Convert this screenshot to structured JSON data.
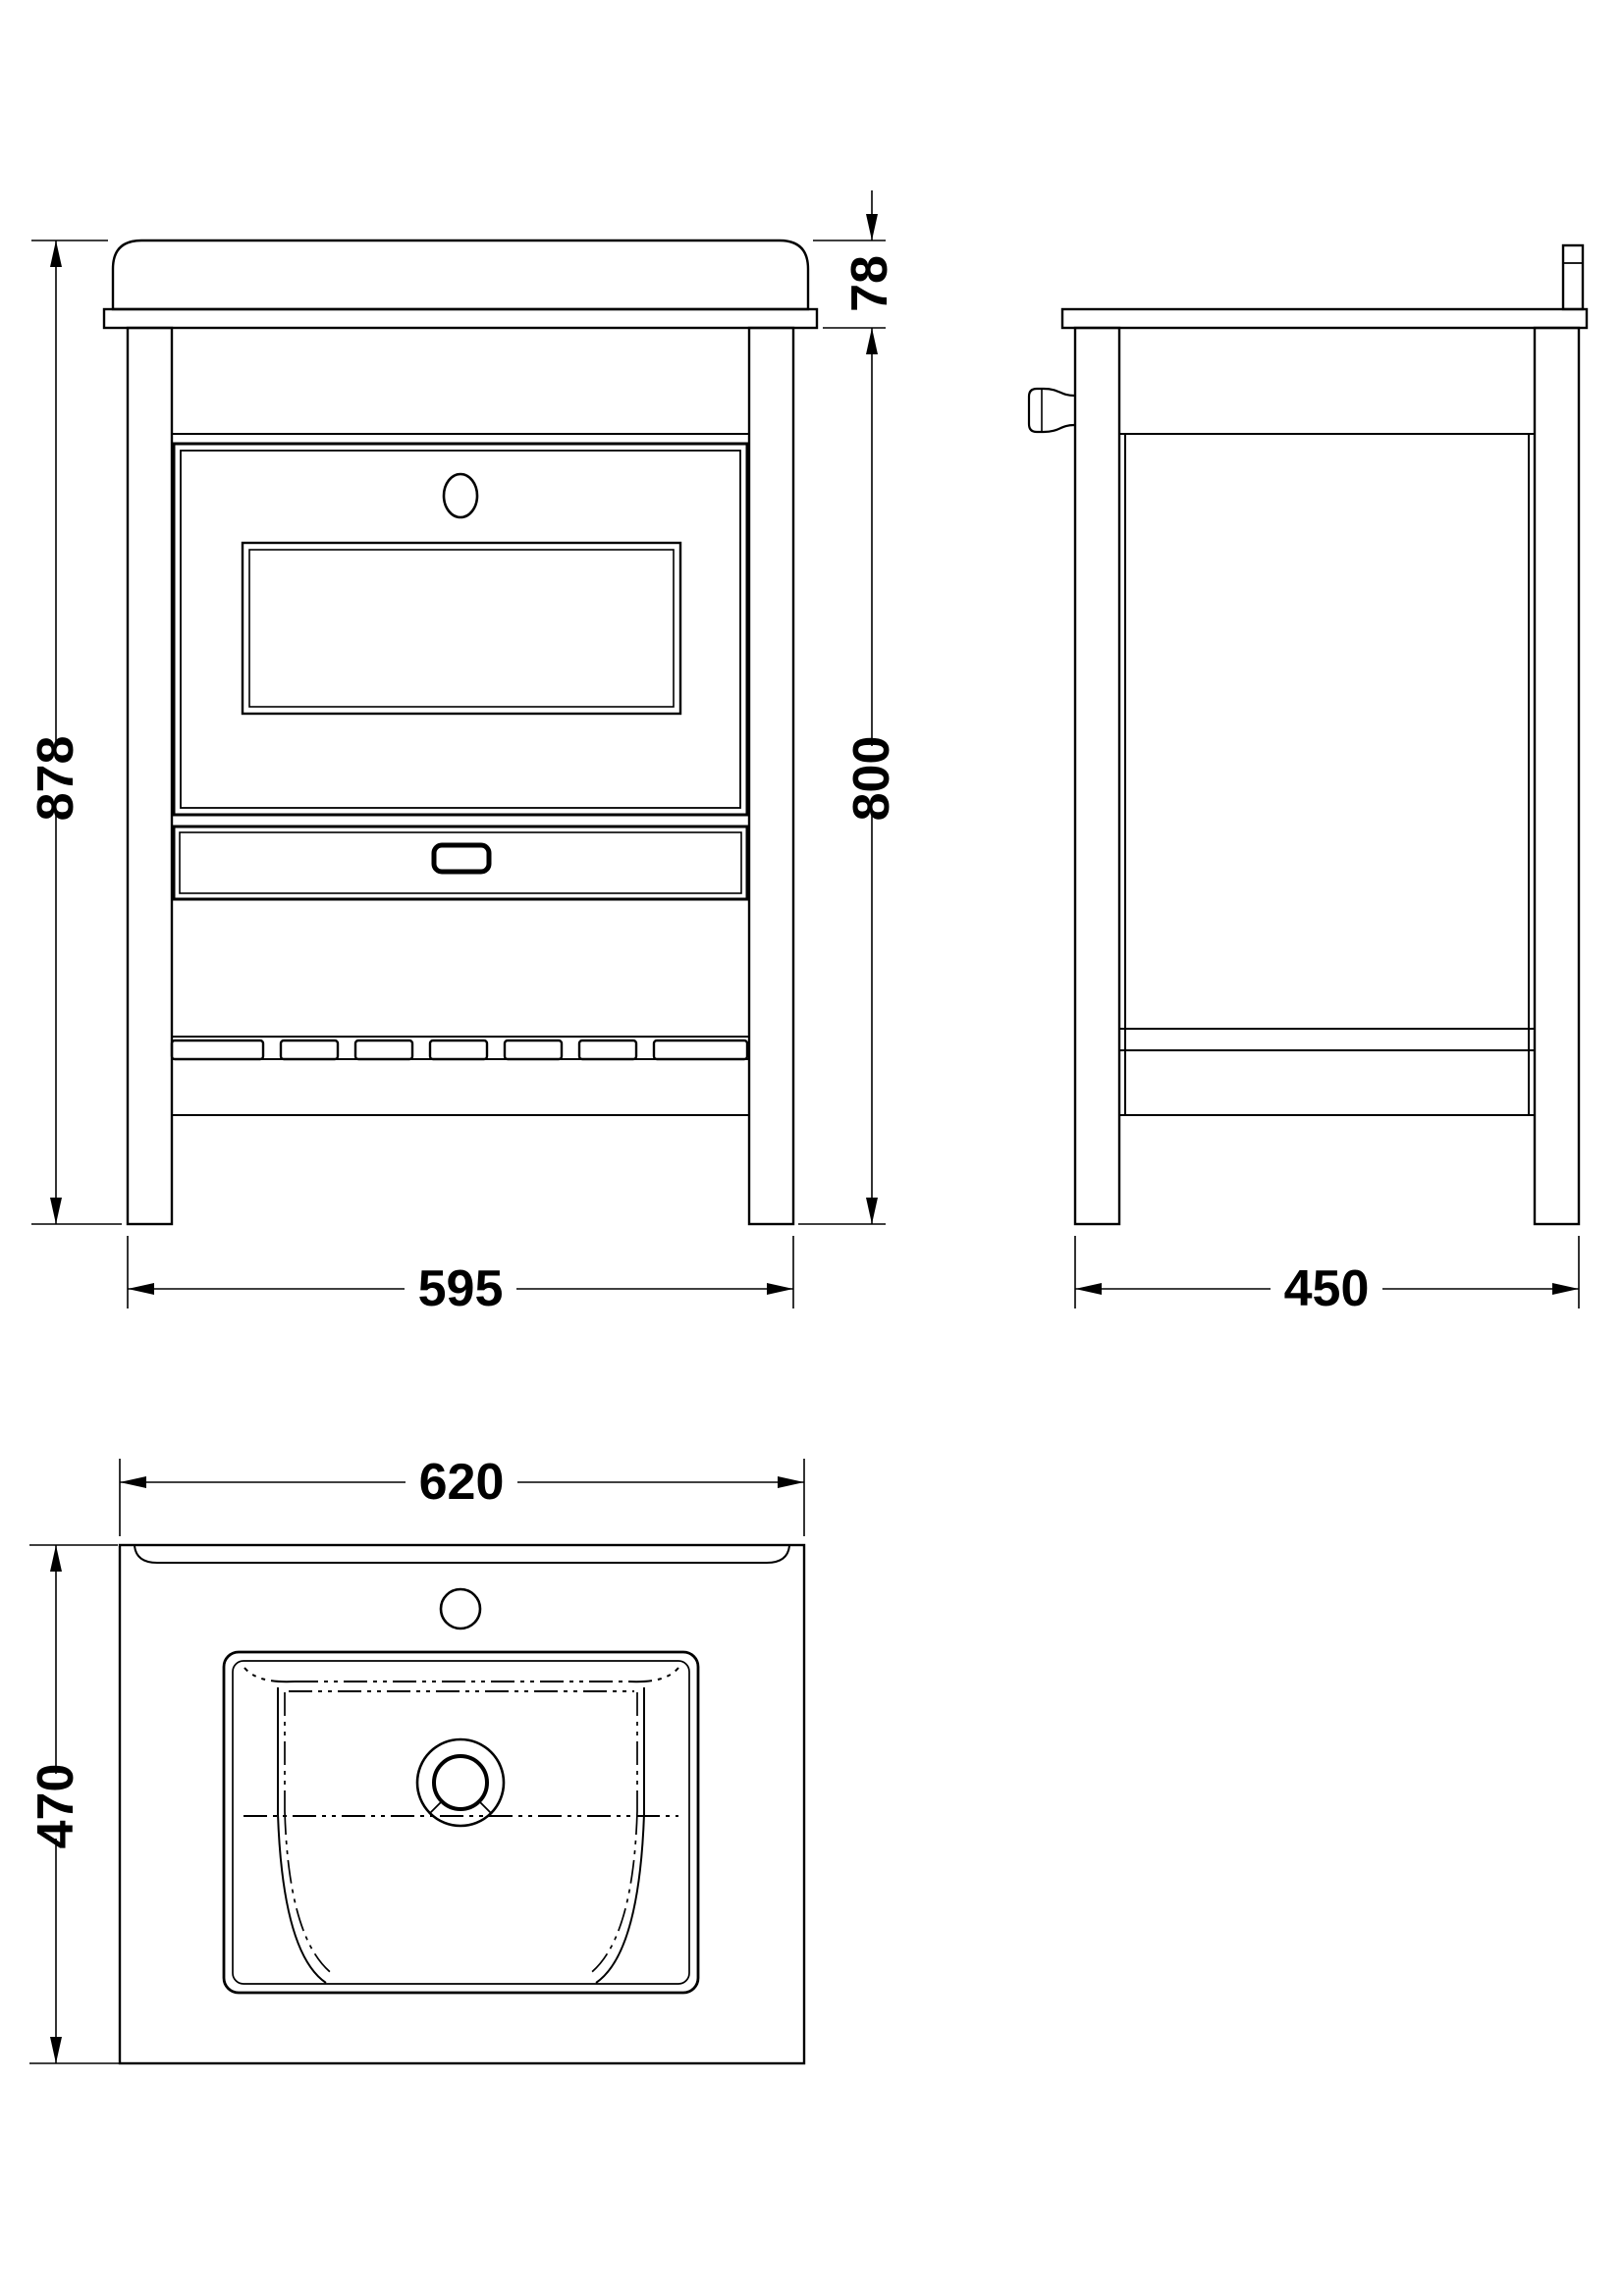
{
  "drawing": {
    "background": "#ffffff",
    "line_color": "#000000",
    "dimensions": {
      "front_total_height": "878",
      "basin_top_height": "78",
      "cabinet_height": "800",
      "front_width": "595",
      "side_depth": "450",
      "basin_width": "620",
      "basin_depth": "470"
    }
  }
}
